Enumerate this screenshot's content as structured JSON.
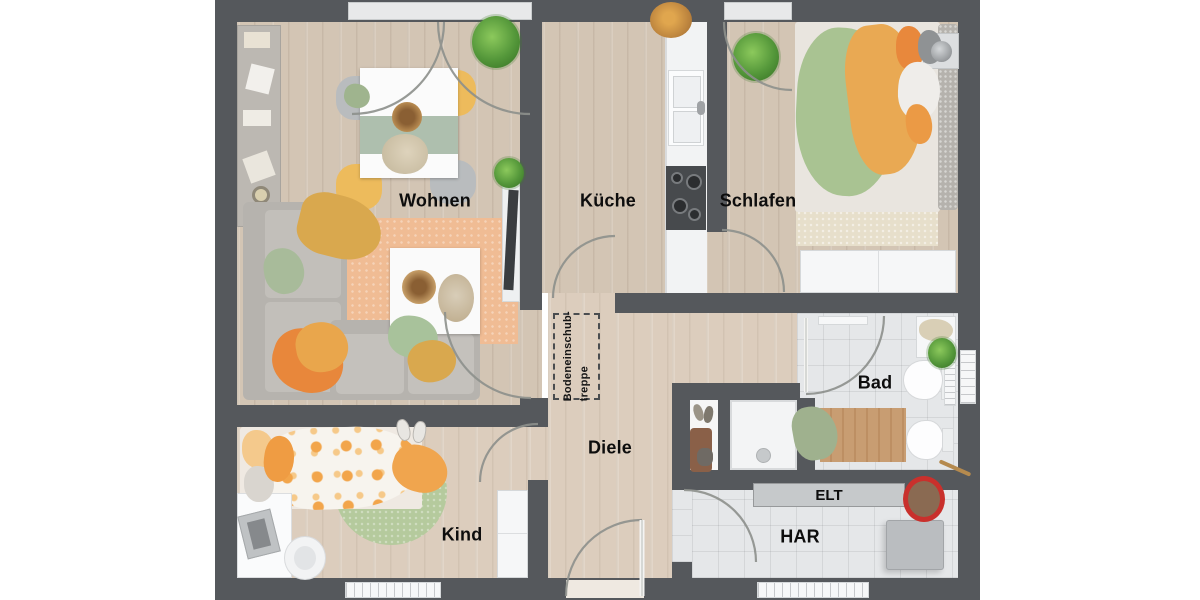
{
  "rooms": [
    {
      "id": "wohnen",
      "label": "Wohnen"
    },
    {
      "id": "kueche",
      "label": "Küche"
    },
    {
      "id": "schlafen",
      "label": "Schlafen"
    },
    {
      "id": "bad",
      "label": "Bad"
    },
    {
      "id": "diele",
      "label": "Diele"
    },
    {
      "id": "kind",
      "label": "Kind"
    },
    {
      "id": "har",
      "label": "HAR"
    }
  ],
  "annotations": {
    "elt_label": "ELT",
    "attic_stairs_line1": "Bodeneinschub-",
    "attic_stairs_line2": "treppe"
  },
  "colors": {
    "wall": "#55585c",
    "wood_floor": "#d3c5b4",
    "wood_floor_light": "#dccdbd",
    "tile_floor": "#e5e7e9",
    "accent_orange": "#e8963f",
    "accent_yellow": "#e3b45c",
    "accent_green": "#a9c392",
    "rug_orange": "#f0bc94",
    "door_arc": "#8d908c",
    "label_text": "#0d0d0d"
  }
}
